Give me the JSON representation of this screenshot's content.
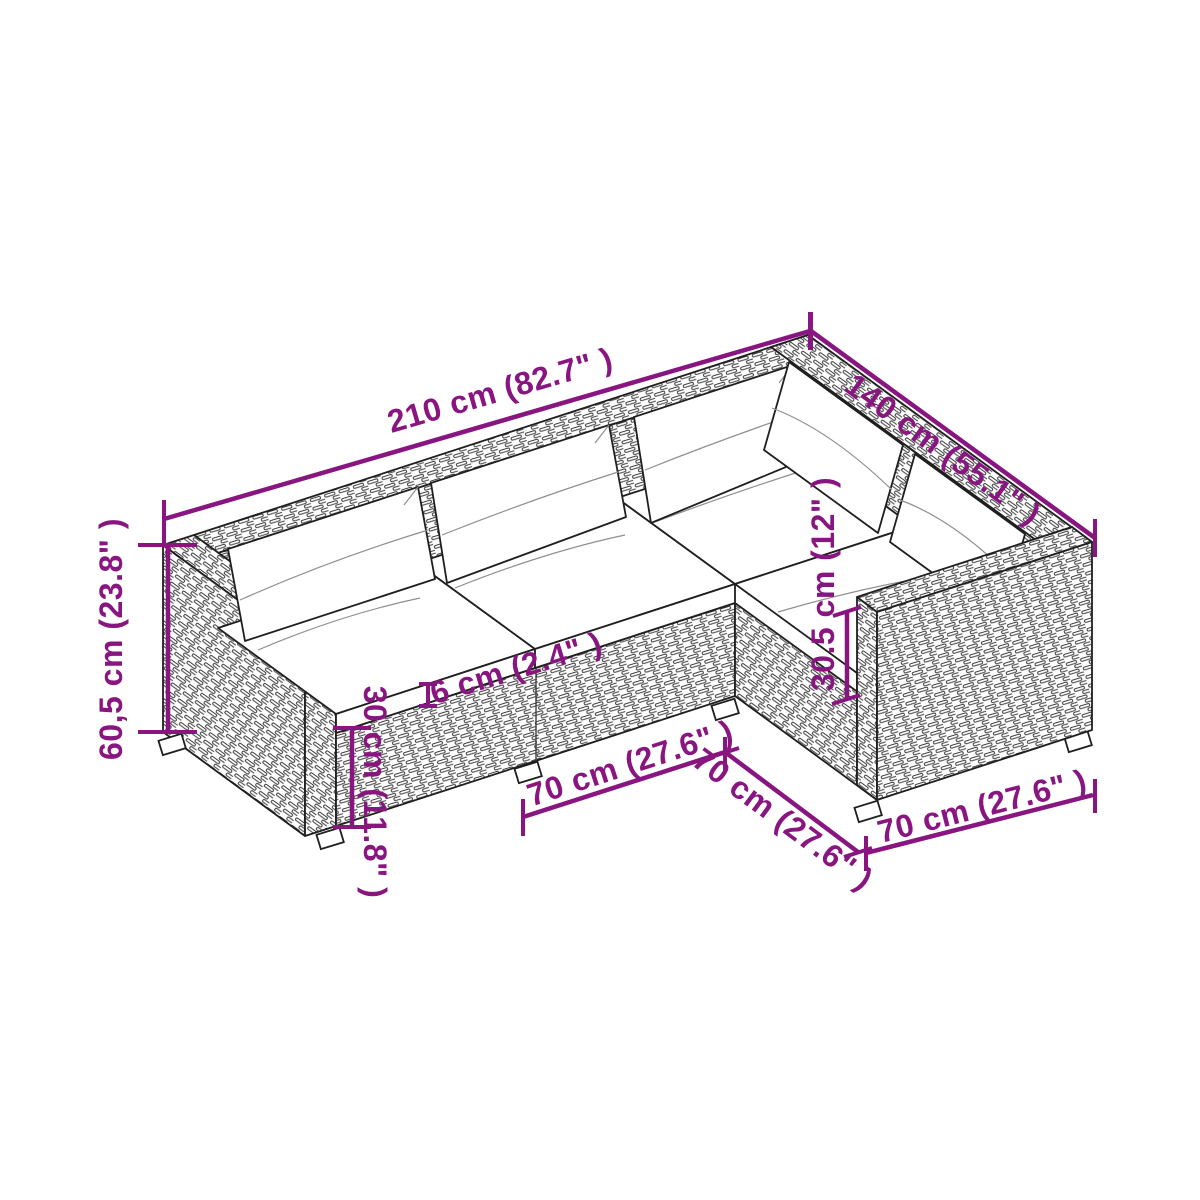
{
  "colors": {
    "accent": "#891580",
    "ink": "#1f1f1f",
    "wicker_line": "#3d3d3d",
    "cushion": "#ffffff",
    "background": "#ffffff"
  },
  "annotations": {
    "total_length": {
      "label": "210 cm (82.7\" )"
    },
    "right_depth": {
      "label": "140 cm (55.1\" )"
    },
    "total_height": {
      "label": "60,5 cm (23.8\" )"
    },
    "base_height": {
      "label": "30 cm (11.8\" )"
    },
    "seat_cushion_thickness": {
      "label": "6 cm (2.4\" )"
    },
    "backrest_height": {
      "label": "30.5 cm (12\" )"
    },
    "front_module_width": {
      "label": "70 cm (27.6\" )"
    },
    "side_module_depth": {
      "label": "70 cm (27.6\" )"
    },
    "right_module_width": {
      "label": "70 cm (27.6\" )"
    }
  },
  "illustration": {
    "subject": "l-shaped-rattan-lounge-sofa-line-drawing"
  }
}
